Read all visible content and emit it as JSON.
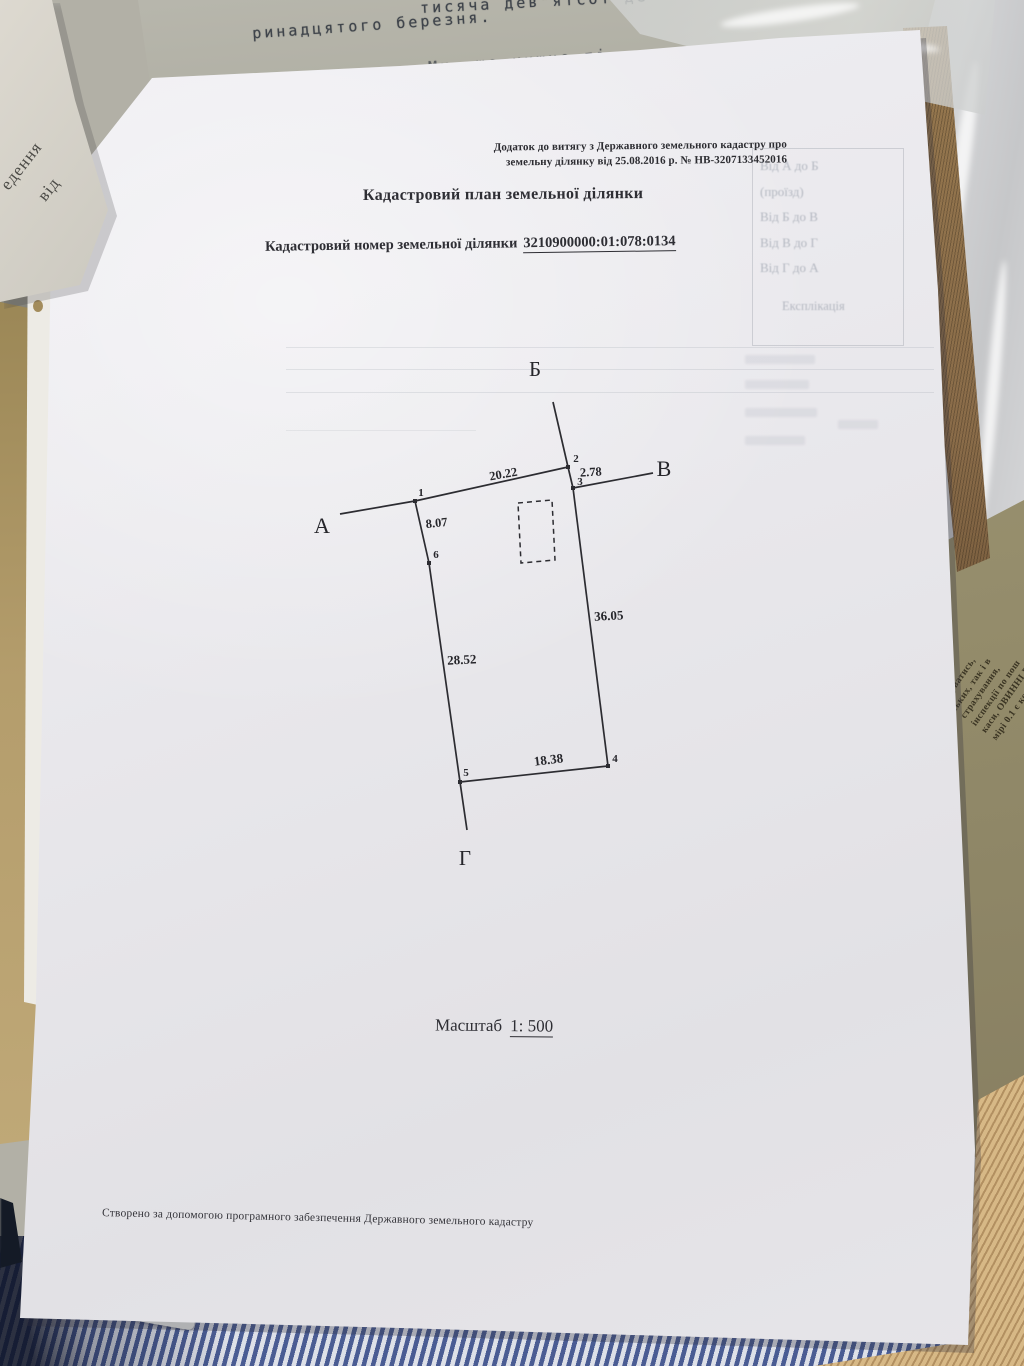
{
  "background": {
    "typewriter_lines": [
      "тисяча дев\"ятсот де",
      "ринадцятого березня.",
      "Ми, що нижче пі"
    ],
    "corner_page_lines": [
      "едення",
      "від"
    ],
    "side_doc_lines": [
      "казуватись,",
      "ських, так і в",
      "страхування,",
      "інспекції по пош",
      "каси, ОВИННІ ВН",
      "мірі 0.1 є  коп."
    ]
  },
  "document": {
    "annex_note_line1": "Додаток до витягу з Державного земельного кадастру про",
    "annex_note_line2": "земельну ділянку від 25.08.2016 р. № НВ-3207133452016",
    "title": "Кадастровий план земельної ділянки",
    "cad_label": "Кадастровий номер земельної ділянки",
    "cad_number": "3210900000:01:078:0134",
    "scale_label": "Масштаб",
    "scale_value": "1: 500",
    "footer": "Створено за допомогою програмного забезпечення Державного земельного кадастру",
    "bleed_line1": "Від А до Б",
    "bleed_line2": "(проїзд)",
    "bleed_line3": "Від Б до В",
    "bleed_line4": "Від В до Г",
    "bleed_line5": "Від Г до А",
    "bleed_line6": "Експлікація"
  },
  "diagram": {
    "stroke": "#2c2c31",
    "lines": [
      [
        263,
        62,
        278,
        127
      ],
      [
        278,
        127,
        125,
        161
      ],
      [
        125,
        161,
        50,
        174
      ],
      [
        278,
        127,
        283,
        148
      ],
      [
        283,
        148,
        363,
        133
      ],
      [
        125,
        161,
        139,
        223
      ],
      [
        139,
        223,
        170,
        442
      ],
      [
        283,
        148,
        318,
        426
      ],
      [
        170,
        442,
        318,
        426
      ],
      [
        170,
        442,
        177,
        490
      ]
    ],
    "dashed_rect": [
      [
        228,
        163
      ],
      [
        262,
        160
      ],
      [
        265,
        220
      ],
      [
        231,
        223
      ]
    ],
    "vertices": [
      [
        125,
        161
      ],
      [
        278,
        127
      ],
      [
        283,
        148
      ],
      [
        318,
        426
      ],
      [
        170,
        442
      ],
      [
        139,
        223
      ]
    ],
    "labels": [
      {
        "t": "Б",
        "x": 245,
        "y": 36,
        "s": 21,
        "w": "400"
      },
      {
        "t": "В",
        "x": 374,
        "y": 136,
        "s": 22,
        "w": "400"
      },
      {
        "t": "А",
        "x": 32,
        "y": 193,
        "s": 22,
        "w": "400"
      },
      {
        "t": "Г",
        "x": 175,
        "y": 525,
        "s": 21,
        "w": "400"
      },
      {
        "t": "1",
        "x": 131,
        "y": 156,
        "s": 11,
        "w": "700"
      },
      {
        "t": "2",
        "x": 286,
        "y": 122,
        "s": 11,
        "w": "700"
      },
      {
        "t": "3",
        "x": 290,
        "y": 145,
        "s": 11,
        "w": "700"
      },
      {
        "t": "4",
        "x": 325,
        "y": 422,
        "s": 11,
        "w": "700"
      },
      {
        "t": "5",
        "x": 176,
        "y": 436,
        "s": 11,
        "w": "700"
      },
      {
        "t": "6",
        "x": 146,
        "y": 218,
        "s": 11,
        "w": "700"
      },
      {
        "t": "20.22",
        "x": 214,
        "y": 138,
        "s": 12.5,
        "w": "700",
        "r": -10
      },
      {
        "t": "2.78",
        "x": 301,
        "y": 136,
        "s": 12.5,
        "w": "700",
        "r": -3
      },
      {
        "t": "8.07",
        "x": 147,
        "y": 187,
        "s": 12.5,
        "w": "700",
        "r": -6
      },
      {
        "t": "28.52",
        "x": 172,
        "y": 324,
        "s": 13,
        "w": "700",
        "r": -3
      },
      {
        "t": "36.05",
        "x": 319,
        "y": 280,
        "s": 13,
        "w": "700",
        "r": -3
      },
      {
        "t": "18.38",
        "x": 259,
        "y": 424,
        "s": 13,
        "w": "700",
        "r": -7
      }
    ]
  }
}
